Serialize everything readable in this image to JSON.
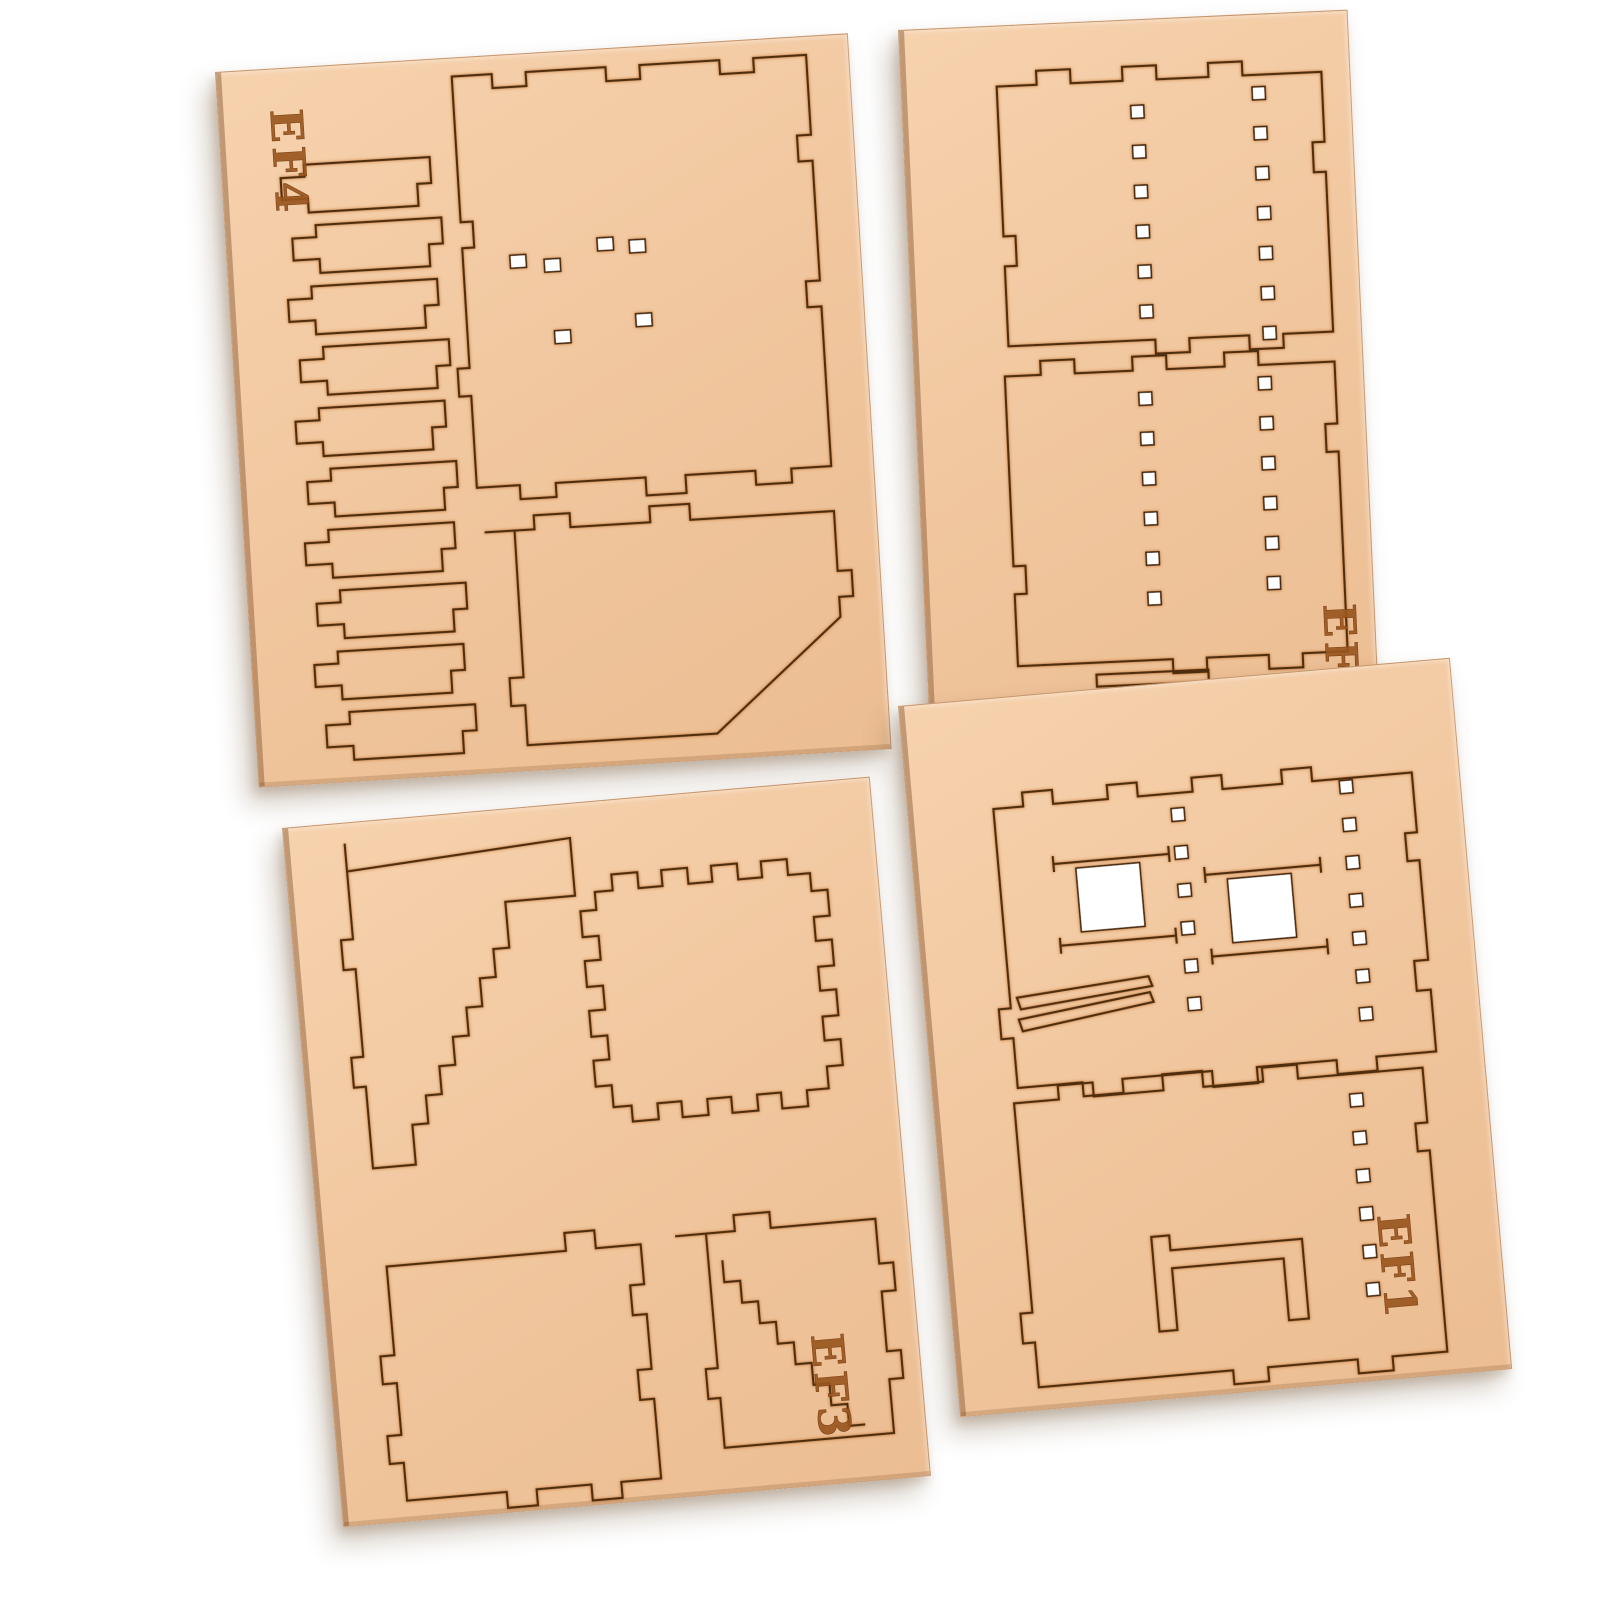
{
  "scene": {
    "description": "Product photo of four tan laser-cut MDF hobby-kit sheets on a white background",
    "background_color": "#ffffff",
    "sheet_color": "#f1c79f",
    "cut_line_color": "#4f2e10",
    "engraving_color": "#9a571f"
  },
  "sheets": [
    {
      "label": "EF4",
      "position": "top-left",
      "contents": "column of 10 stepped plank pieces, large tabbed panel with 6 small square holes, lower panel with diagonal corner"
    },
    {
      "label": "EF2",
      "position": "top-right",
      "contents": "two large castellated wall panels, each with two vertical rows of small square peg holes"
    },
    {
      "label": "EF3",
      "position": "bottom-left",
      "contents": "stair-step pieces, large square panel with finger-joint tabs on all sides, two lower panels"
    },
    {
      "label": "EF1",
      "position": "bottom-right",
      "contents": "two wall panels with two open square windows, door frame cut-out and vertical rows of small square peg holes"
    }
  ]
}
